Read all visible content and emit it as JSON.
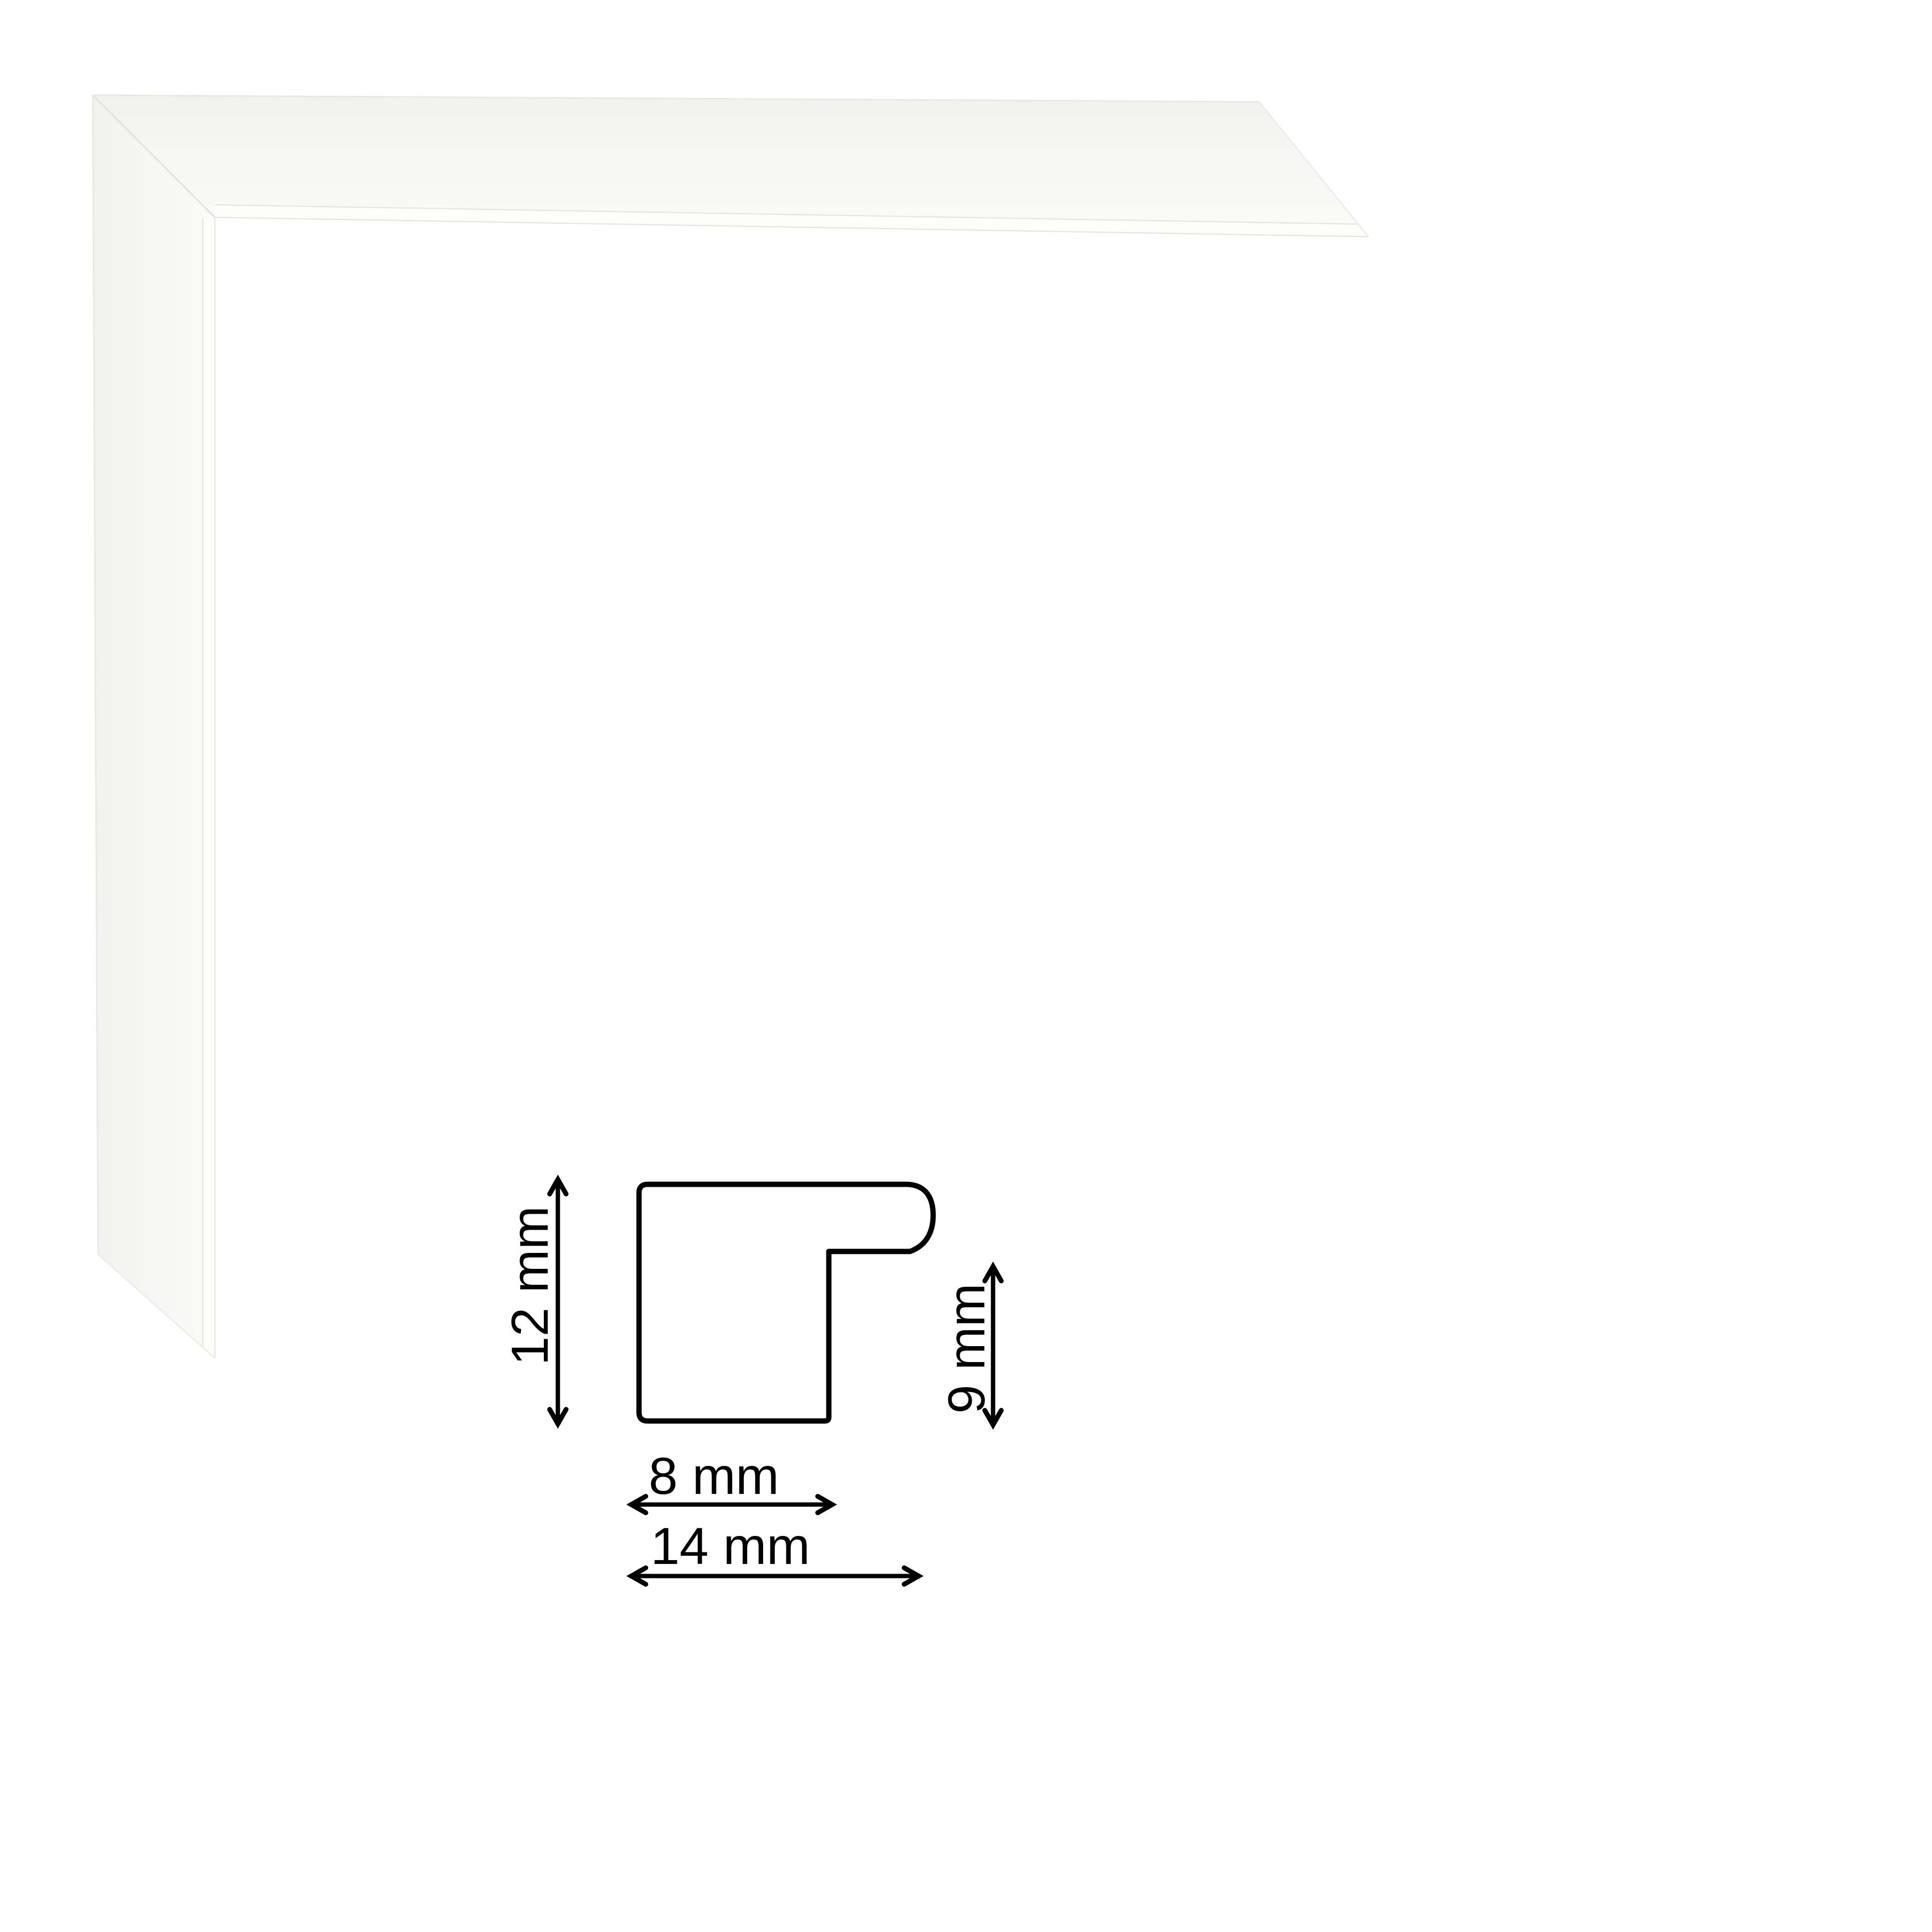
{
  "page": {
    "background": "#ffffff",
    "kind": "picture-frame-moulding-product-image"
  },
  "photo": {
    "subject": "white picture frame corner sample, mitered joint, top-left",
    "colors": {
      "face_outer": "#f1f1ef",
      "face": "#f6f6f4",
      "face_inner": "#fafaf8",
      "lip_highlight": "#fdfdfc",
      "edge_line": "#e7e7e4",
      "inner_edge_line": "#e5e5e2",
      "miter_seam": "#dededb",
      "cut_edge_line": "#ececea"
    }
  },
  "diagram": {
    "ink": "#000000",
    "unit": "mm",
    "profile_height": {
      "label": "12 mm",
      "value": 12
    },
    "rabbet_height": {
      "label": "9 mm",
      "value": 9
    },
    "face_width": {
      "label": "8 mm",
      "value": 8
    },
    "total_width": {
      "label": "14 mm",
      "value": 14
    }
  }
}
